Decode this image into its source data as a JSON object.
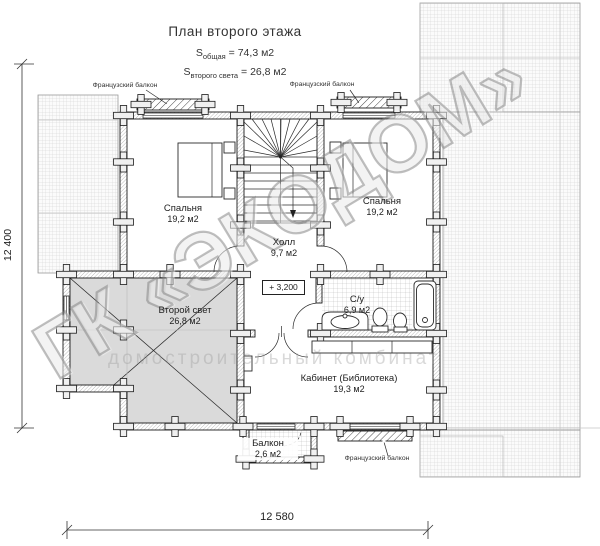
{
  "title": "План второго этажа",
  "area_summary": [
    {
      "prefix": "S",
      "sub": "общая",
      "value": " = 74,3 м2"
    },
    {
      "prefix": "S",
      "sub": "второго света",
      "value": " = 26,8 м2"
    }
  ],
  "rooms": {
    "bedroom_left": {
      "name": "Спальня",
      "area": "19,2 м2"
    },
    "bedroom_right": {
      "name": "Спальня",
      "area": "19,2 м2"
    },
    "hall": {
      "name": "Холл",
      "area": "9,7 м2"
    },
    "second_light": {
      "name": "Второй свет",
      "area": "26,8 м2"
    },
    "bathroom": {
      "name": "С/у",
      "area": "6,9 м2"
    },
    "office": {
      "name": "Кабинет (Библиотека)",
      "area": "19,3 м2"
    },
    "balcony": {
      "name": "Балкон",
      "area": "2,6 м2"
    }
  },
  "annotations": {
    "french_balcony": "Французский балкон",
    "elevation_mark": "+ 3,200"
  },
  "dimensions": {
    "left_total": "12 400",
    "bottom_total": "12 580"
  },
  "watermark": {
    "main": "ГК «ЭКОДОМ»",
    "sub": "домостроительный комбинат"
  },
  "colors": {
    "wall_line": "#1a1a1a",
    "second_light_fill": "#dadada",
    "roof_hatch": "#cdcdcd",
    "watermark_gray": "#9a9a9a",
    "background": "#ffffff"
  }
}
